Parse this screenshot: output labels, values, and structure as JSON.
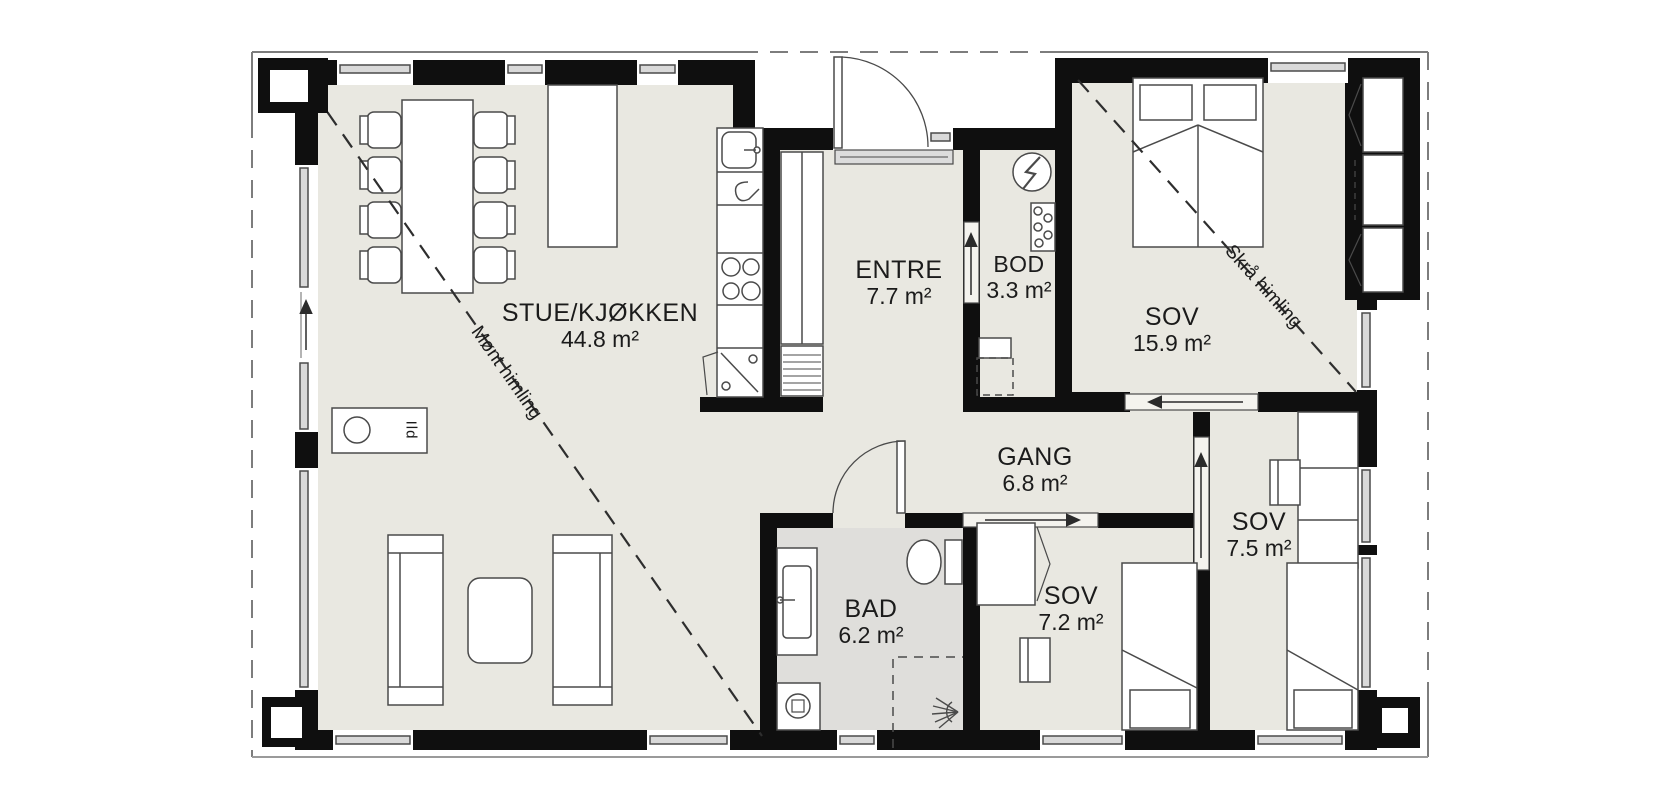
{
  "plan": {
    "rooms": {
      "stue": {
        "name": "STUE/KJØKKEN",
        "area": "44.8 m²"
      },
      "entre": {
        "name": "ENTRE",
        "area": "7.7 m²"
      },
      "bod": {
        "name": "BOD",
        "area": "3.3 m²"
      },
      "sov_master": {
        "name": "SOV",
        "area": "15.9 m²"
      },
      "gang": {
        "name": "GANG",
        "area": "6.8 m²"
      },
      "sov_mid": {
        "name": "SOV",
        "area": "7.5 m²"
      },
      "sov_small": {
        "name": "SOV",
        "area": "7.2 m²"
      },
      "bad": {
        "name": "BAD",
        "area": "6.2 m²"
      }
    },
    "annotations": {
      "ridge_ceiling": "Mønt himling",
      "sloped_ceiling": "Skrå himling",
      "stove": "Ild"
    },
    "colors": {
      "wall": "#0f0f0f",
      "floor": "#e9e8e1",
      "bad_floor": "#dfdedb",
      "line": "#4a4a4a",
      "roof_dash": "#7d7d7d",
      "text": "#1b1b1b",
      "background": "#ffffff"
    }
  }
}
